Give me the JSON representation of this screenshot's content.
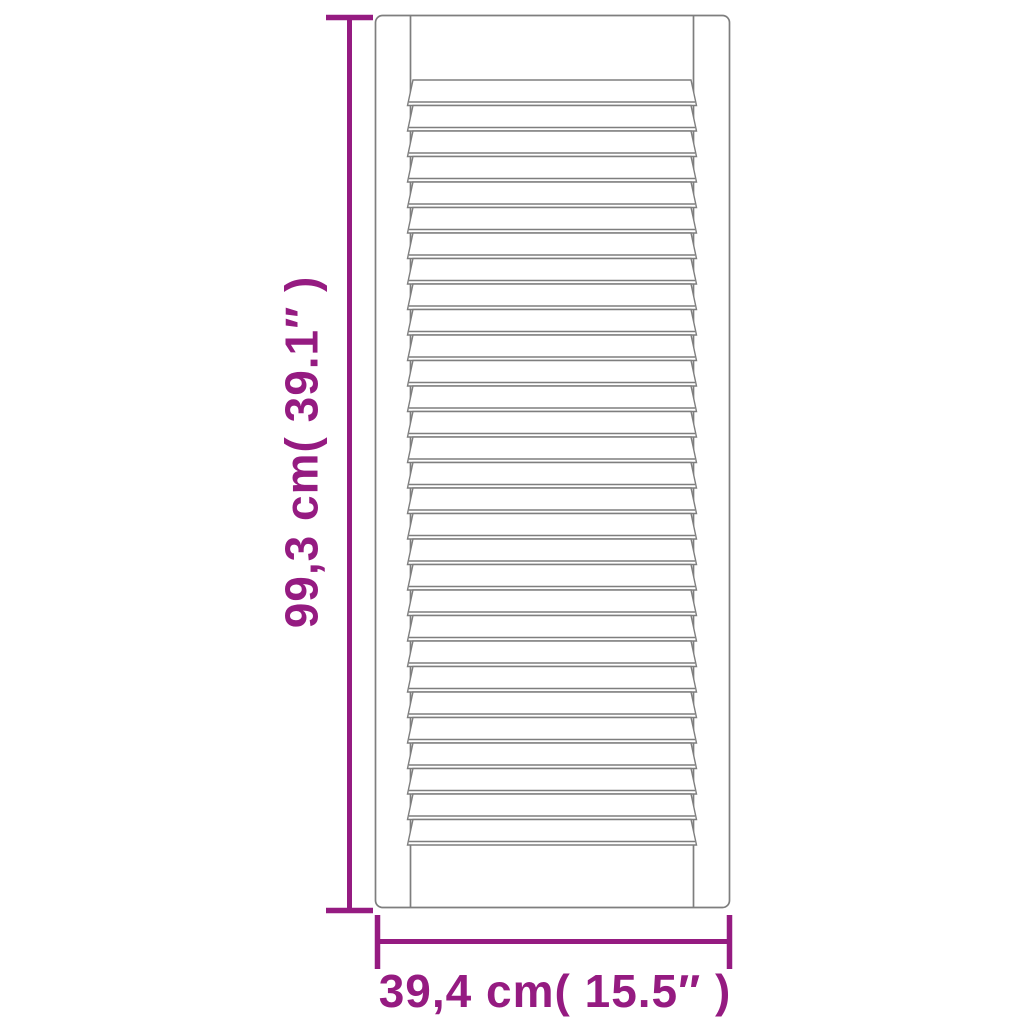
{
  "figure": {
    "subject": "louvred-door-panel-dimension-diagram",
    "background": "#ffffff",
    "height_dimension": {
      "label": "99,3 cm( 39.1″ )"
    },
    "width_dimension": {
      "label": "39,4 cm( 15.5″ )"
    },
    "door": {
      "slat_count": 30,
      "style": "louvered"
    },
    "colors": {
      "dimension_accent": "#951b81",
      "drawing_outline": "#7e7e7e"
    }
  }
}
